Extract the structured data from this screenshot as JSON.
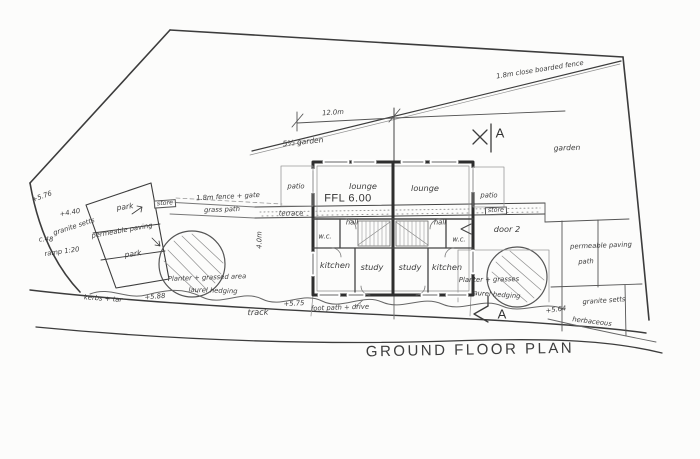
{
  "drawing_title": "GROUND FLOOR PLAN",
  "section_markers": {
    "top": "A",
    "bottom": "A"
  },
  "dimensions": {
    "building_width": "12.0m",
    "terrace_depth": "4.0m"
  },
  "building": {
    "ffl": "FFL 6.00",
    "rooms": {
      "lounge_left": "lounge",
      "lounge_right": "lounge",
      "hall_left": "hall",
      "hall_right": "hall",
      "wc_left": "w.c.",
      "wc_right": "w.c.",
      "kitchen_left": "kitchen",
      "kitchen_right": "kitchen",
      "study_left": "study",
      "study_right": "study"
    },
    "patio_left": "patio",
    "patio_right": "patio",
    "terrace": "terrace",
    "door_note": "door 2",
    "store_left": "store",
    "store_right": "store"
  },
  "site": {
    "fence_note": "1.8m close boarded fence",
    "fence_gate_note": "1.8m fence + gate",
    "garden_left": "5½ garden",
    "garden_right": "garden",
    "grass_path": "grass path",
    "track": "track",
    "footpath_drive": "foot path + drive",
    "kerbs": "kerbs + tar",
    "herbaceous": "herbaceous",
    "park_upper": "park",
    "park_lower": "park",
    "permeable_paving_left": "permeable paving",
    "permeable_paving_right": "permeable paving",
    "granite_setts_left": "granite setts",
    "granite_setts_right": "granite setts",
    "path_right": "path",
    "planter_left": "Planter + grassed area",
    "planter_right": "Planter + grasses",
    "laurel_left": "laurel hedging",
    "laurel_right": "laurel hedging",
    "ramp_note": "ramp 1:20",
    "c_note": "c.48"
  },
  "levels": {
    "l576": "+5.76",
    "l440": "+4.40",
    "l588": "+5.88",
    "l575": "+5.75",
    "l564": "+5.64"
  },
  "colors": {
    "ink": "#3c3c3c",
    "paper": "#fcfcfb",
    "pencil": "#8f8f8f"
  }
}
